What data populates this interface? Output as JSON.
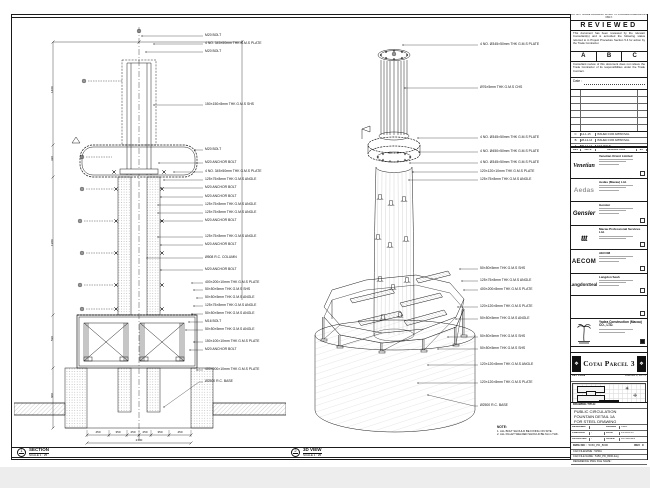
{
  "left_view": {
    "marker_no": "1",
    "title": "SECTION",
    "scale": "SCALE 1 : 25",
    "callouts": [
      {
        "y": 19,
        "sx": 128,
        "t": "M20 BOLT"
      },
      {
        "y": 27,
        "sx": 140,
        "t": "4 NO. 345×50mm THK G.M.S PLATE"
      },
      {
        "y": 35,
        "sx": 132,
        "t": "M20 BOLT"
      },
      {
        "y": 88,
        "sx": 140,
        "t": "150×150×8mm THK G.M.S SHS"
      },
      {
        "y": 133,
        "sx": 181,
        "t": "M20 BOLT"
      },
      {
        "y": 146,
        "sx": 145,
        "t": "M20 ANCHOR BOLT"
      },
      {
        "y": 155,
        "sx": 160,
        "t": "4 NO. 345×50mm THK G.M.S PLATE"
      },
      {
        "y": 163,
        "sx": 150,
        "t": "125×75×8mm THK G.M.S ANGLE"
      },
      {
        "y": 171,
        "sx": 147,
        "t": "M20 ANCHOR BOLT"
      },
      {
        "y": 180,
        "sx": 147,
        "t": "M20 ANCHOR BOLT"
      },
      {
        "y": 188,
        "sx": 144,
        "t": "125×75×8mm THK G.M.S ANGLE"
      },
      {
        "y": 196,
        "sx": 144,
        "t": "125×75×8mm THK G.M.S ANGLE"
      },
      {
        "y": 204,
        "sx": 147,
        "t": "M20 ANCHOR BOLT"
      },
      {
        "y": 220,
        "sx": 144,
        "t": "125×75×8mm THK G.M.S ANGLE"
      },
      {
        "y": 228,
        "sx": 147,
        "t": "M20 ANCHOR BOLT"
      },
      {
        "y": 241,
        "sx": 133,
        "t": "Ø508 R.C. COLUMN"
      },
      {
        "y": 253,
        "sx": 147,
        "t": "M20 ANCHOR BOLT"
      },
      {
        "y": 266,
        "sx": 178,
        "t": "400×200×10mm THK G.M.S PLATE"
      },
      {
        "y": 273,
        "sx": 180,
        "t": "50×50×5mm THK G.M.S SHS"
      },
      {
        "y": 281,
        "sx": 183,
        "t": "50×50×5mm THK G.M.S ANGLE"
      },
      {
        "y": 289,
        "sx": 180,
        "t": "125×75×8mm THK G.M.S ANGLE"
      },
      {
        "y": 297,
        "sx": 178,
        "t": "50×50×5mm THK G.M.S ANGLE"
      },
      {
        "y": 305,
        "sx": 175,
        "t": "M16 BOLT"
      },
      {
        "y": 313,
        "sx": 172,
        "t": "50×50×5mm THK G.M.S ANGLE"
      },
      {
        "y": 325,
        "sx": 180,
        "t": "150×100×10mm THK G.M.S PLATE"
      },
      {
        "y": 333,
        "sx": 176,
        "t": "M20 ANCHOR BOLT"
      },
      {
        "y": 353,
        "sx": 183,
        "t": "400×200×10mm THK G.M.S PLATE"
      },
      {
        "y": 365,
        "sx": 150,
        "sy": 390,
        "t": "Ø2500 R.C. BASE"
      }
    ],
    "dims_bottom": [
      {
        "x": 84,
        "t": "450"
      },
      {
        "x": 104,
        "t": "350"
      },
      {
        "x": 119,
        "t": "250"
      },
      {
        "x": 131,
        "t": "250"
      },
      {
        "x": 146,
        "t": "350"
      },
      {
        "x": 166,
        "t": "450"
      }
    ],
    "dim_total": {
      "x": 125,
      "t": "2100"
    },
    "dims_left": [
      {
        "y": 76,
        "t": "1460"
      },
      {
        "y": 144,
        "t": "320"
      },
      {
        "y": 229,
        "t": "1380"
      },
      {
        "y": 324,
        "t": "530"
      },
      {
        "y": 381,
        "t": "600"
      }
    ]
  },
  "iso_view": {
    "marker_no": "2",
    "title": "3D VIEW",
    "scale": "SCALE 1 : 25",
    "callouts": [
      {
        "y": 28,
        "sx": 115,
        "t": "4 NO. Ø345×50mm THK G.M.S PLATE"
      },
      {
        "y": 71,
        "sx": 117,
        "t": "Ø76×5mm THK G.M.S CHS"
      },
      {
        "y": 121,
        "sx": 130,
        "t": "4 NO. Ø345×50mm THK G.M.S PLATE"
      },
      {
        "y": 135,
        "sx": 131,
        "t": "4 NO. Ø450×50mm THK G.M.S PLATE"
      },
      {
        "y": 146,
        "sx": 122,
        "t": "4 NO. Ø345×50mm THK G.M.S PLATE"
      },
      {
        "y": 155,
        "sx": 125,
        "t": "120×120×10mm THK G.M.S PLATE"
      },
      {
        "y": 163,
        "sx": 121,
        "t": "125×75×8mm THK G.M.S ANGLE"
      },
      {
        "y": 252,
        "sx": 172,
        "t": "50×50×5mm THK G.M.S SHS"
      },
      {
        "y": 264,
        "sx": 174,
        "t": "125×75×8mm THK G.M.S ANGLE"
      },
      {
        "y": 273,
        "sx": 176,
        "t": "400×200×8mm THK G.M.S PLATE"
      },
      {
        "y": 290,
        "sx": 170,
        "t": "120×120×8mm THK G.M.S PLATE"
      },
      {
        "y": 302,
        "sx": 168,
        "t": "50×50×5mm THK G.M.S ANGLE"
      },
      {
        "y": 320,
        "sx": 160,
        "t": "50×50×5mm THK G.M.S SHS"
      },
      {
        "y": 332,
        "sx": 150,
        "t": "50×50×5mm THK G.M.S SHS"
      },
      {
        "y": 348,
        "sx": 140,
        "t": "120×120×8mm THK G.M.S ANGLE"
      },
      {
        "y": 366,
        "sx": 130,
        "t": "120×120×8mm THK G.M.S PLATE"
      },
      {
        "y": 389,
        "sx": 140,
        "sy": 378,
        "t": "Ø2500 R.C. BASE"
      }
    ],
    "note_title": "NOTE:",
    "notes": [
      "1. ALL BOLT SHOULD BE FIXING ON SITE.",
      "2. ALL FILLET WELDED SHOULD BE 6mm THK."
    ]
  },
  "stamp": {
    "top_strip": "DO NOT SCALE DRAWING. WORK TO FIGURED DIMENSIONS ONLY.",
    "title": "REVIEWED",
    "para1": "This document has been reviewed by the relevant Consultant(s) and is accorded the following status referred to in Project Procedure Section 5.4 for action by the Trade Contractor.",
    "grades": [
      "A",
      "B",
      "C"
    ],
    "para2": "Consultant review of this document does not relieve the Trade Contractor of its responsibilities under the Trade Contract.",
    "date_label": "Date :"
  },
  "revisions": {
    "empty_rows": 7,
    "entries": [
      {
        "rev": "C",
        "date": "14-1-15",
        "desc": "ISSUED FOR APPROVAL"
      },
      {
        "rev": "B",
        "date": "28-12-14",
        "desc": "ISSUED FOR APPROVAL"
      },
      {
        "rev": "A",
        "date": "05-12-14",
        "desc": "1ST ISSUE"
      }
    ],
    "headers": [
      "REV",
      "DATE",
      "DESCRIPTION",
      "BY"
    ]
  },
  "companies": [
    {
      "logo": "Venetian",
      "logo_class": "lg-venetian",
      "name": "Venetian Orient Limited",
      "h": 26,
      "bars": 3,
      "cbx": true
    },
    {
      "logo": "Aedas",
      "logo_class": "lg-aedas",
      "name": "Aedas (Macau) Ltd.",
      "h": 23,
      "bars": 3,
      "cbx": false
    },
    {
      "logo": "Gensler",
      "logo_class": "lg-gensler",
      "name": "Gensler",
      "h": 24,
      "bars": 3,
      "cbx": true
    },
    {
      "logo": "ttt",
      "logo_class": "lg-ttt",
      "name": "Macau Professional Services Ltd.",
      "h": 24,
      "bars": 2,
      "cbx": true
    },
    {
      "logo": "AECOM",
      "logo_class": "lg-aecom",
      "name": "AECOM",
      "h": 24,
      "bars": 3,
      "cbx": true
    },
    {
      "logo": "LangdonSeah",
      "logo_class": "lg-langdon",
      "name": "Langdon Seah",
      "h": 22,
      "bars": 3,
      "cbx": true
    },
    {
      "logo": "",
      "logo_class": "",
      "name": "",
      "h": 23,
      "bars": 0,
      "cbx": true
    }
  ],
  "contractor": {
    "name": "Yadea Construction (Macau) CO., LTD.",
    "bars": 2
  },
  "project": {
    "label": "PROJECT TITLE :",
    "title": "Cotai Parcel 3"
  },
  "key_plan": {
    "label": "KEY PLAN",
    "right": "PARCEL 3, LOT 2"
  },
  "title_block": {
    "label": "DRAWING TITLE:",
    "lines": [
      "PUBLIC CIRCULATION",
      "FOUNTAIN DETAIL 1A",
      "FOR STEEL DRAWING"
    ],
    "grid": [
      [
        "DESIGNED",
        "",
        "DRAWN",
        "CWD"
      ],
      [
        "CHECKED",
        "-",
        "DATE",
        "14-JAN-15"
      ],
      [
        "APPROVED",
        "-",
        "SCALE",
        "AS SHOWN"
      ]
    ],
    "dwg_label": "DWG NO :",
    "dwg_no": "5150_PD_8000",
    "rev_label": "REV",
    "rev": "C",
    "cad_rows": [
      "CAD FILENAME : 5150A",
      "CAD FILE NAME : 5150_PD_8000.dwg",
      "REFERENCE DWG FILE NAME :"
    ]
  }
}
